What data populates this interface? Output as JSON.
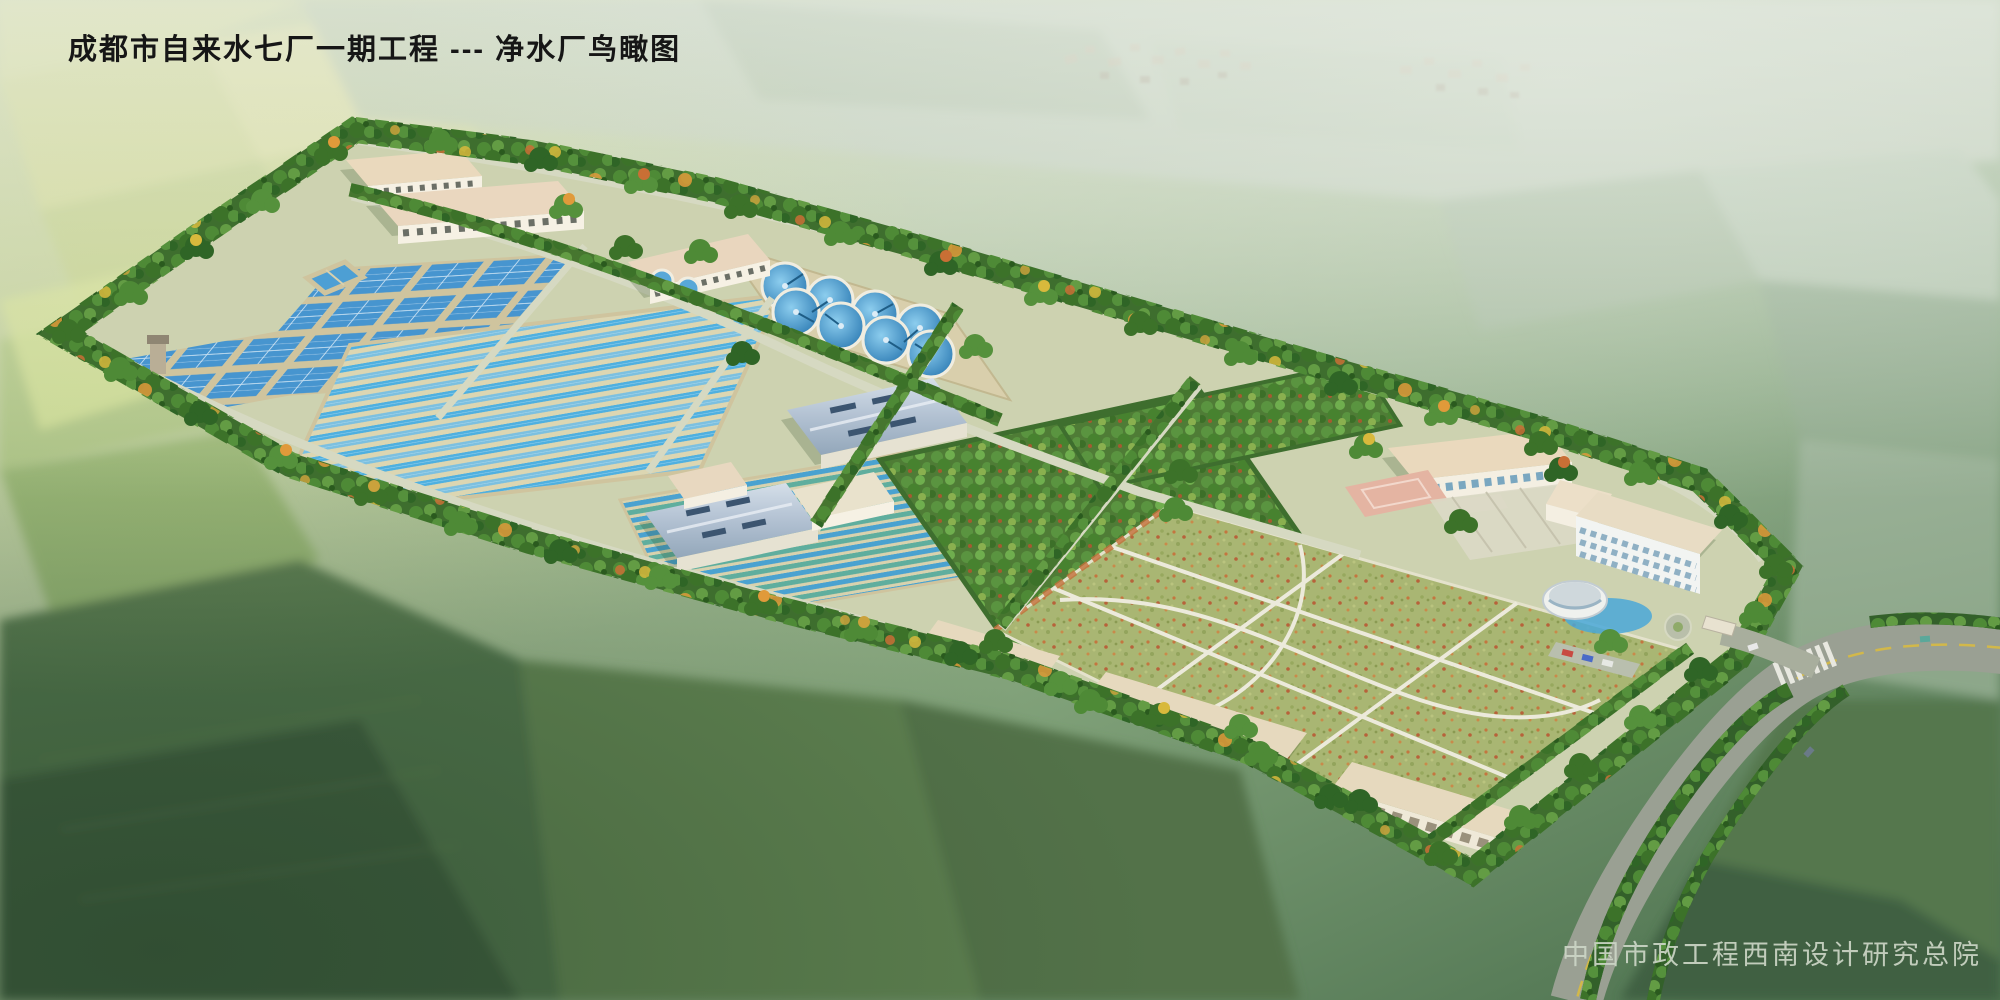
{
  "title": "成都市自来水七厂一期工程 --- 净水厂鸟瞰图",
  "credit": "中国市政工程西南设计研究总院",
  "palette": {
    "haze_white": "#eef2ea",
    "field_light": "#c6cf97",
    "field_dark": "#4e7048",
    "tree_green": "#3e6e2e",
    "tree_autumn": "#e09a3a",
    "water_blue": "#4fb0e0",
    "basin_frame": "#cfc49e",
    "roof_beige": "#ead9bd",
    "roof_metal_blue": "#b9c6d6",
    "wall_white": "#f4efe2",
    "road_asphalt": "#9aa093",
    "path_light": "#d6d9c2",
    "lawn_green": "#a9b673",
    "court_pink": "#e4b4a2"
  },
  "scene": {
    "type": "aerial architectural rendering",
    "features": [
      "perimeter tree belt",
      "sedimentation basin grid",
      "long filter basin channels",
      "circular clarifier group of eight",
      "two small round tanks",
      "elevated contact basin",
      "water tower",
      "arched-roof pump station halls",
      "chemical dosing buildings",
      "orchard green belt",
      "central lawn with white paths",
      "administration building with basketball court",
      "four-storey dormitory office block",
      "circular glass pavilion with pool",
      "garage and workshop rows",
      "entrance gate with roundabout",
      "main road with crosswalk and cars",
      "surrounding farmland patchwork",
      "distant hazy village"
    ]
  }
}
